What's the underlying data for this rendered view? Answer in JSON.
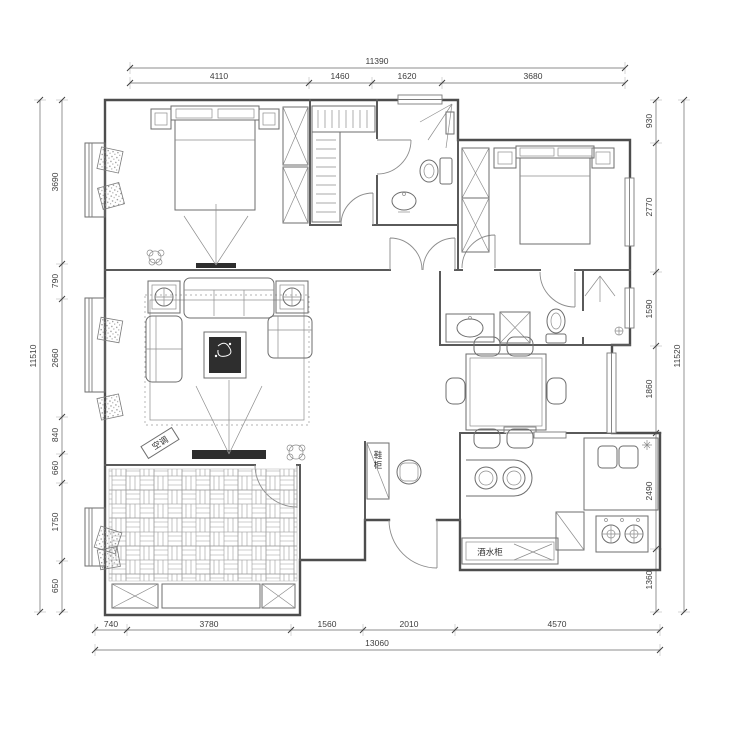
{
  "drawing": {
    "dimensions": {
      "top": {
        "total": "11390",
        "segments": [
          "4110",
          "1460",
          "1620",
          "3680"
        ]
      },
      "left": {
        "total": "11510",
        "segments": [
          "3690",
          "790",
          "2660",
          "840",
          "660",
          "1750",
          "650"
        ]
      },
      "right": {
        "total": "11520",
        "segments": [
          "930",
          "2770",
          "1590",
          "1860",
          "2490",
          "1360"
        ]
      },
      "bottom": {
        "total": "13060",
        "segments": [
          "740",
          "3780",
          "1560",
          "2010",
          "4570"
        ]
      }
    },
    "labels": {
      "air_conditioner": "空调",
      "shoe_cabinet": "鞋柜",
      "wine_cabinet": "酒水柜"
    }
  }
}
